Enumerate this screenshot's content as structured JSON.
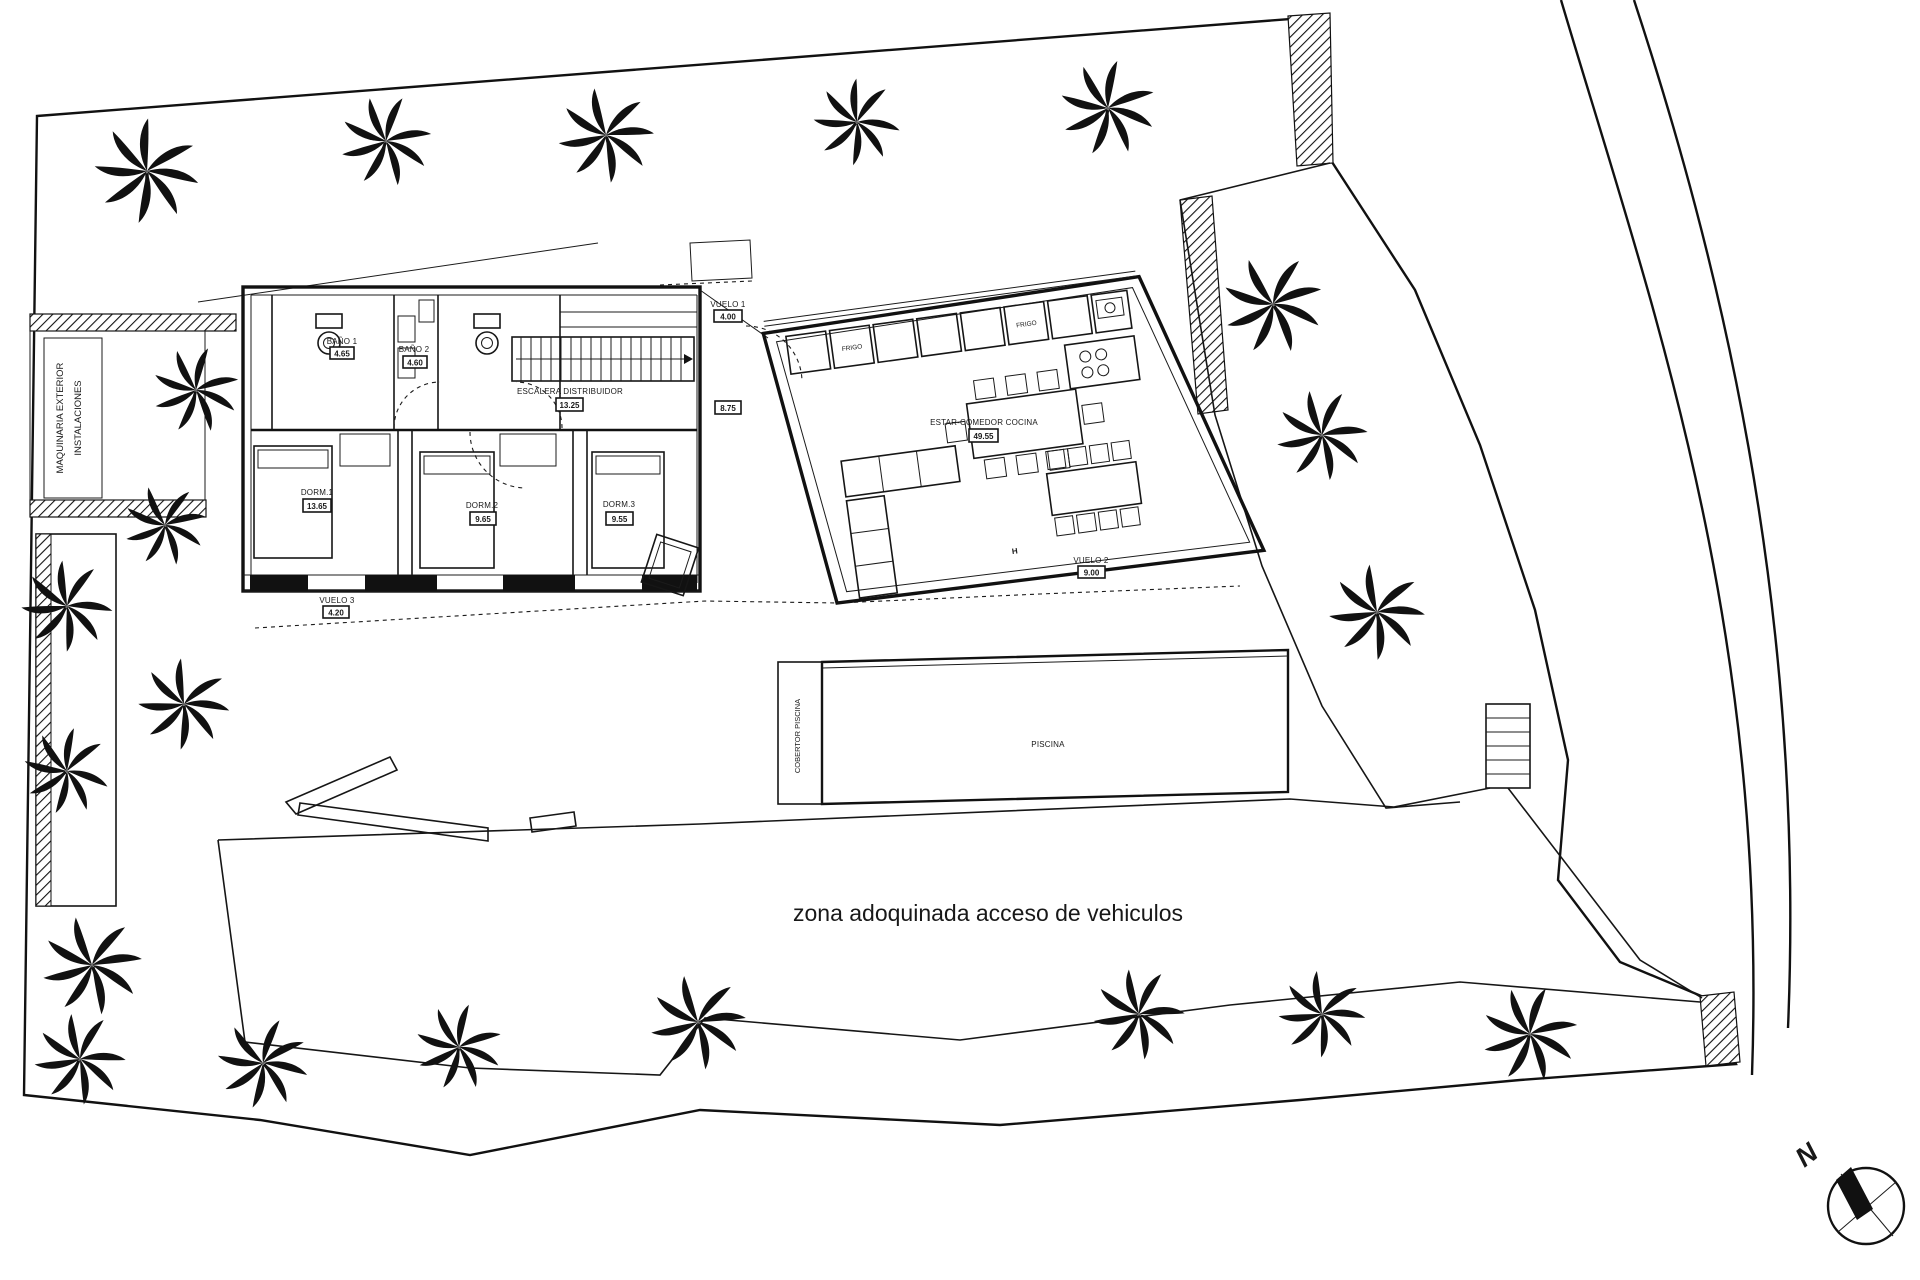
{
  "colors": {
    "ink": "#151515",
    "paper": "#ffffff"
  },
  "rooms": {
    "bano1": {
      "label": "BAÑO 1",
      "area": "4.65"
    },
    "bano2": {
      "label": "BAÑO 2",
      "area": "4.60"
    },
    "escalera": {
      "label": "ESCALERA DISTRIBUIDOR",
      "area": "13.25"
    },
    "hall": {
      "area": "8.75"
    },
    "dorm1": {
      "label": "DORM.1",
      "area": "13.65"
    },
    "dorm2": {
      "label": "DORM.2",
      "area": "9.65"
    },
    "dorm3": {
      "label": "DORM.3",
      "area": "9.55"
    },
    "estar": {
      "label": "ESTAR-COMEDOR COCINA",
      "area": "49.55"
    },
    "vuelo1": {
      "label": "VUELO 1",
      "area": "4.00"
    },
    "vuelo2": {
      "label": "VUELO 2",
      "area": "9.00"
    },
    "vuelo3": {
      "label": "VUELO 3",
      "area": "4.20"
    }
  },
  "labels": {
    "maquinaria_1": "MAQUINARIA EXTERIOR",
    "maquinaria_2": "INSTALACIONES",
    "cobertor": "COBERTOR PISCINA",
    "piscina": "PISCINA",
    "zona": "zona adoquinada acceso de vehiculos",
    "frigo": "FRIGO",
    "wall_marker": "H",
    "north": "N"
  }
}
